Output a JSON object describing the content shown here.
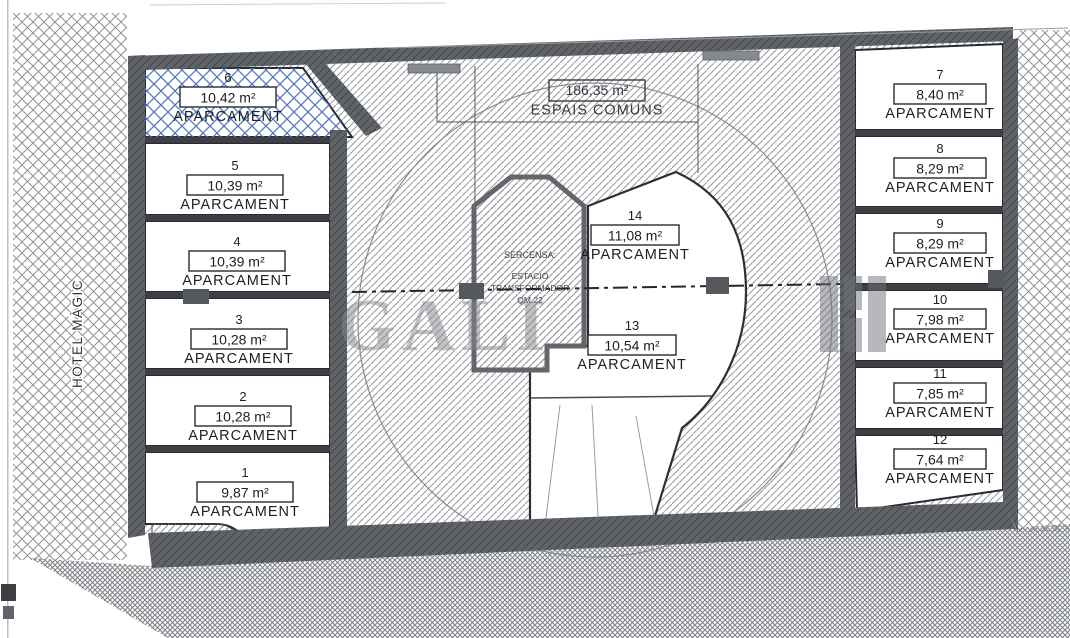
{
  "plan": {
    "hotel_label": "HOTEL MÀGIC",
    "common_area": {
      "area": "186,35 m²",
      "name": "ESPAIS COMUNS"
    },
    "transformer_room": {
      "line1": "SERCENSA:",
      "line2": "ESTACIÓ",
      "line3": "TRANSFORMADOR",
      "line4": "QM.22"
    },
    "watermark_text": "GALI",
    "stall_label": "APARCAMENT",
    "stalls": {
      "s1": {
        "num": "1",
        "area": "9,87 m²"
      },
      "s2": {
        "num": "2",
        "area": "10,28 m²"
      },
      "s3": {
        "num": "3",
        "area": "10,28 m²"
      },
      "s4": {
        "num": "4",
        "area": "10,39 m²"
      },
      "s5": {
        "num": "5",
        "area": "10,39 m²"
      },
      "s6": {
        "num": "6",
        "area": "10,42 m²"
      },
      "s7": {
        "num": "7",
        "area": "8,40 m²"
      },
      "s8": {
        "num": "8",
        "area": "8,29 m²"
      },
      "s9": {
        "num": "9",
        "area": "8,29 m²"
      },
      "s10": {
        "num": "10",
        "area": "7,98 m²"
      },
      "s11": {
        "num": "11",
        "area": "7,85 m²"
      },
      "s12": {
        "num": "12",
        "area": "7,64 m²"
      },
      "s13": {
        "num": "13",
        "area": "10,54 m²"
      },
      "s14": {
        "num": "14",
        "area": "11,08 m²"
      }
    },
    "colors": {
      "blue_hatch": "#5577bd",
      "wall": "#606368",
      "hatch_line": "#9599a0",
      "ground_line": "#7e8287",
      "text": "#1f1f23",
      "watermark": "#83868b"
    }
  }
}
